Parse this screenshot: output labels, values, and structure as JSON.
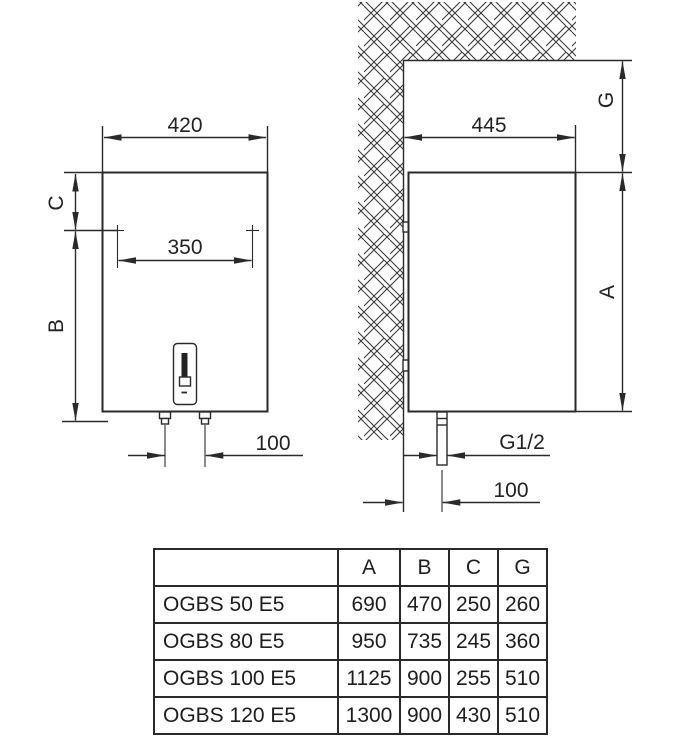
{
  "page": {
    "background": "#ffffff",
    "line_color": "#2a2a2a",
    "drawing_type": "water-heater dimension drawing"
  },
  "front_view": {
    "width_dim": "420",
    "bracket_spacing_dim": "350",
    "pipe_spacing_dim": "100",
    "top_offset_label": "C",
    "height_label": "B"
  },
  "side_view": {
    "depth_dim": "445",
    "top_clearance_label": "G",
    "height_label": "A",
    "pipe_thread_dim": "G1/2",
    "wall_offset_dim": "100"
  },
  "table": {
    "headers": [
      "A",
      "B",
      "C",
      "G"
    ],
    "rows": [
      {
        "model": "OGBS 50 E5",
        "values": [
          "690",
          "470",
          "250",
          "260"
        ]
      },
      {
        "model": "OGBS 80 E5",
        "values": [
          "950",
          "735",
          "245",
          "360"
        ]
      },
      {
        "model": "OGBS 100 E5",
        "values": [
          "1125",
          "900",
          "255",
          "510"
        ]
      },
      {
        "model": "OGBS 120 E5",
        "values": [
          "1300",
          "900",
          "430",
          "510"
        ]
      }
    ]
  }
}
